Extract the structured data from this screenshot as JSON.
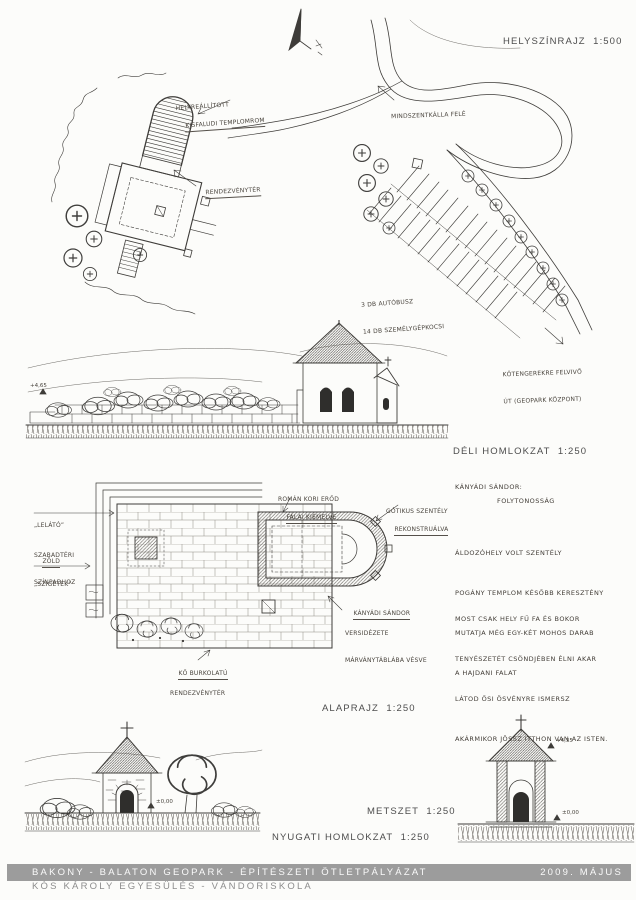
{
  "labels": {
    "site_plan": "HELYSZÍNRAJZ  1:500",
    "south_elevation": "DÉLI HOMLOKZAT  1:250",
    "floor_plan": "ALAPRAJZ  1:250",
    "section": "METSZET  1:250",
    "west_elevation": "NYUGATI HOMLOKZAT  1:250"
  },
  "site_annotations": {
    "church_ruin": [
      "HELYREÁLLÍTOTT",
      "KISFALUDI TEMPLOMROM"
    ],
    "event_square": "RENDEZVÉNYTÉR",
    "to_mindszentkalla": "MINDSZENTKÁLLA FELÉ",
    "parking": [
      "3 DB AUTÓBUSZ",
      "14 DB SZEMÉLYGÉPKOCSI"
    ],
    "road_note": [
      "KŐTENGEREKRE FELVIVŐ",
      "ÚT (GEOPARK KÖZPONT)"
    ]
  },
  "plan_annotations": {
    "grandstand": [
      "„LELÁTÓ”",
      "SZABADTÉRI",
      "SZÍNPADHOZ"
    ],
    "green_islands": [
      "ZÖLD",
      "„SZIGETEK”"
    ],
    "roman_walls": [
      "ROMÁN KORI ERŐD",
      "FALAI KIEMELVE"
    ],
    "gothic_sanctuary": [
      "GÓTIKUS SZENTÉLY",
      "REKONSTRUÁLVA"
    ],
    "poem_plaque": [
      "KÁNYÁDI SÁNDOR",
      "VERSIDÉZETE",
      "MÁRVÁNYTÁBLÁBA VÉSVE"
    ],
    "stone_paving": [
      "KŐ BURKOLATÚ",
      "RENDEZVÉNYTÉR"
    ]
  },
  "poem": {
    "author": "KÁNYÁDI SÁNDOR:",
    "title": "FOLYTONOSSÁG",
    "stanza1": [
      "ÁLDOZÓHELY VOLT SZENTÉLY",
      "POGÁNY TEMPLOM KÉSŐBB KERESZTÉNY",
      "MUTATJA MÉG EGY-KÉT MOHOS DARAB",
      "A HAJDANI FALAT"
    ],
    "stanza2": [
      "MOST CSAK HELY FŰ FA ÉS BOKOR",
      "TENYÉSZETÉT CSÖNDJÉBEN ÉLNI AKAR",
      "LÁTOD ŐSI ÖSVÉNYRE ISMERSZ",
      "AKÁRMIKOR JÖSSZ ITTHON VAN AZ ISTEN."
    ]
  },
  "levels": {
    "south_top": "+4,65",
    "west_zero": "±0,00",
    "section_top": "+4,35",
    "section_zero": "±0,00"
  },
  "footer": {
    "line1": "BAKONY - BALATON GEOPARK - ÉPÍTÉSZETI ÖTLETPÁLYÁZAT",
    "line2": "KÓS KÁROLY EGYESÜLÉS - VÁNDORISKOLA",
    "date": "2009. MÁJUS",
    "bar_color": "#9c9c9c"
  }
}
